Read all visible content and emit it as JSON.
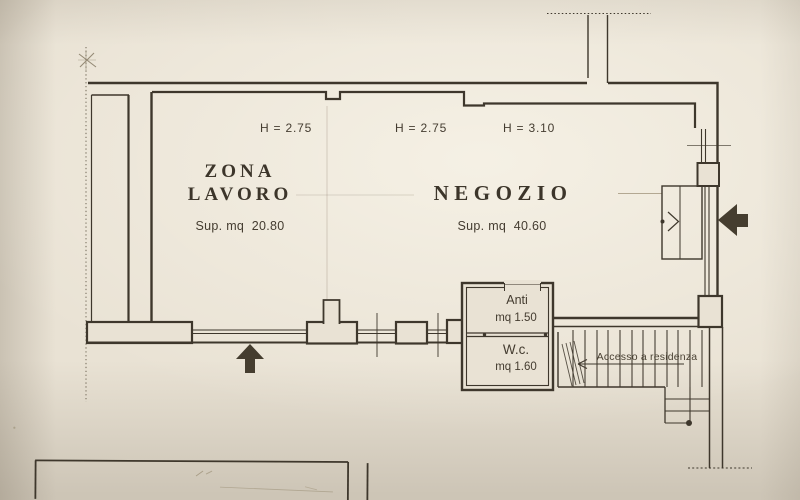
{
  "plan": {
    "height_labels": [
      {
        "text": "H = 2.75"
      },
      {
        "text": "H = 2.75"
      },
      {
        "text": "H = 3.10"
      }
    ],
    "rooms": {
      "zona_lavoro": {
        "name_line1": "ZONA",
        "name_line2": "LAVORO",
        "area": "Sup. mq  20.80"
      },
      "negozio": {
        "name": "NEGOZIO",
        "area": "Sup. mq  40.60"
      },
      "anti": {
        "name": "Anti",
        "area": "mq 1.50"
      },
      "wc": {
        "name": "W.c.",
        "area": "mq 1.60"
      }
    },
    "annotations": {
      "stair_access": "Accesso a residenza"
    },
    "symbols": {
      "entrance_arrow_bottom": "up-arrow",
      "entrance_arrow_right": "left-arrow",
      "stair_direction_arrow": "left-arrow",
      "boundary_marker": "x-mark"
    },
    "colors": {
      "paper": "#e9e2d4",
      "ink": "#3e372c",
      "pencil": "#9d9178"
    }
  }
}
